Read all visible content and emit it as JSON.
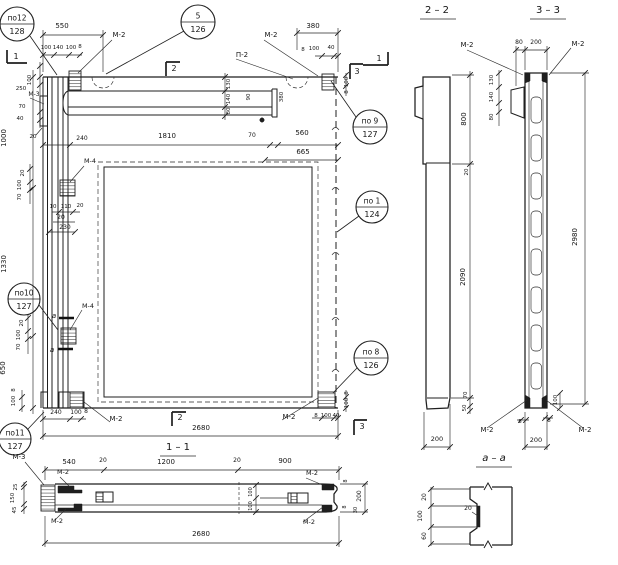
{
  "colors": {
    "ink": "#1f1f1f",
    "paper": "#ffffff"
  },
  "views": {
    "main_elevation": {
      "labels": [
        {
          "t": "550",
          "x": 62,
          "y": 28
        },
        {
          "t": "100",
          "x": 46,
          "y": 49,
          "s": 5.5
        },
        {
          "t": "140",
          "x": 58,
          "y": 49,
          "s": 5.5
        },
        {
          "t": "100",
          "x": 71,
          "y": 49,
          "s": 5.5
        },
        {
          "t": "8",
          "x": 80,
          "y": 48,
          "s": 5.5
        },
        {
          "t": "М-2",
          "x": 119,
          "y": 37
        },
        {
          "t": "П-2",
          "x": 242,
          "y": 57
        },
        {
          "t": "М-2",
          "x": 271,
          "y": 37
        },
        {
          "t": "380",
          "x": 313,
          "y": 28
        },
        {
          "t": "8",
          "x": 303,
          "y": 51,
          "s": 5.5
        },
        {
          "t": "100",
          "x": 314,
          "y": 50,
          "s": 5.5
        },
        {
          "t": "40",
          "x": 331,
          "y": 49,
          "s": 5.5
        },
        {
          "t": "1",
          "x": 16,
          "y": 59,
          "s": 8,
          "n": "section-mark-1"
        },
        {
          "t": "2",
          "x": 174,
          "y": 71,
          "s": 8,
          "n": "section-mark-2"
        },
        {
          "t": "1",
          "x": 379,
          "y": 61,
          "s": 8,
          "n": "section-mark-1"
        },
        {
          "t": "3",
          "x": 357,
          "y": 74,
          "s": 8,
          "n": "section-mark-3"
        },
        {
          "t": "100",
          "x": 31,
          "y": 80,
          "r": 1,
          "s": 5.5
        },
        {
          "t": "250",
          "x": 21,
          "y": 90,
          "s": 5.5
        },
        {
          "t": "М-3",
          "x": 34,
          "y": 96,
          "s": 6
        },
        {
          "t": "70",
          "x": 22,
          "y": 108,
          "s": 5.5
        },
        {
          "t": "40",
          "x": 20,
          "y": 120,
          "s": 5.5
        },
        {
          "t": "1000",
          "x": 6,
          "y": 138,
          "r": 1
        },
        {
          "t": "20",
          "x": 33,
          "y": 138,
          "s": 5.5
        },
        {
          "t": "240",
          "x": 82,
          "y": 140,
          "s": 6
        },
        {
          "t": "1810",
          "x": 167,
          "y": 138
        },
        {
          "t": "130",
          "x": 230,
          "y": 84,
          "r": 1,
          "s": 5.5
        },
        {
          "t": "140",
          "x": 230,
          "y": 99,
          "r": 1,
          "s": 5.5
        },
        {
          "t": "80",
          "x": 230,
          "y": 111,
          "r": 1,
          "s": 5.5
        },
        {
          "t": "90",
          "x": 250,
          "y": 97,
          "r": 1,
          "s": 5.5
        },
        {
          "t": "380",
          "x": 283,
          "y": 97,
          "r": 1,
          "s": 5.5
        },
        {
          "t": "70",
          "x": 252,
          "y": 137,
          "s": 6
        },
        {
          "t": "560",
          "x": 302,
          "y": 135
        },
        {
          "t": "665",
          "x": 303,
          "y": 154
        },
        {
          "t": "М-4",
          "x": 90,
          "y": 163,
          "s": 6.5
        },
        {
          "t": "20",
          "x": 24,
          "y": 173,
          "r": 1,
          "s": 5.5
        },
        {
          "t": "100",
          "x": 21,
          "y": 185,
          "r": 1,
          "s": 5.5
        },
        {
          "t": "70",
          "x": 21,
          "y": 197,
          "r": 1,
          "s": 5.5
        },
        {
          "t": "10",
          "x": 53,
          "y": 208,
          "s": 5.5
        },
        {
          "t": "110",
          "x": 66,
          "y": 208,
          "s": 5.5
        },
        {
          "t": "20",
          "x": 80,
          "y": 207,
          "s": 5.5
        },
        {
          "t": "20",
          "x": 61,
          "y": 219,
          "s": 6
        },
        {
          "t": "230",
          "x": 65,
          "y": 229,
          "s": 6
        },
        {
          "t": "1330",
          "x": 6,
          "y": 264,
          "r": 1
        },
        {
          "t": "М-4",
          "x": 88,
          "y": 308,
          "s": 6.5
        },
        {
          "t": "а",
          "x": 54,
          "y": 318,
          "s": 7,
          "i": 1
        },
        {
          "t": "а",
          "x": 52,
          "y": 352,
          "s": 7,
          "i": 1
        },
        {
          "t": "20",
          "x": 23,
          "y": 323,
          "r": 1,
          "s": 5.5
        },
        {
          "t": "100",
          "x": 20,
          "y": 335,
          "r": 1,
          "s": 5.5
        },
        {
          "t": "70",
          "x": 20,
          "y": 347,
          "r": 1,
          "s": 5.5
        },
        {
          "t": "650",
          "x": 5,
          "y": 368,
          "r": 1
        },
        {
          "t": "8",
          "x": 15,
          "y": 390,
          "r": 1,
          "s": 5.5
        },
        {
          "t": "100",
          "x": 15,
          "y": 401,
          "r": 1,
          "s": 5.5
        },
        {
          "t": "240",
          "x": 56,
          "y": 414,
          "s": 6
        },
        {
          "t": "100",
          "x": 76,
          "y": 414,
          "s": 6
        },
        {
          "t": "8",
          "x": 86,
          "y": 413,
          "s": 6
        },
        {
          "t": "М-2",
          "x": 116,
          "y": 421
        },
        {
          "t": "2",
          "x": 180,
          "y": 420,
          "s": 8,
          "n": "section-mark-2"
        },
        {
          "t": "2680",
          "x": 201,
          "y": 430
        },
        {
          "t": "М-2",
          "x": 289,
          "y": 419
        },
        {
          "t": "8",
          "x": 316,
          "y": 417,
          "s": 5.5
        },
        {
          "t": "100",
          "x": 326,
          "y": 417,
          "s": 5.5
        },
        {
          "t": "40",
          "x": 336,
          "y": 417,
          "s": 5.5
        },
        {
          "t": "3",
          "x": 362,
          "y": 429,
          "s": 8,
          "n": "section-mark-3"
        },
        {
          "t": "100",
          "x": 348,
          "y": 82,
          "r": 1,
          "s": 5.5
        },
        {
          "t": "8",
          "x": 348,
          "y": 92,
          "r": 1,
          "s": 5.5
        },
        {
          "t": "8",
          "x": 348,
          "y": 393,
          "r": 1,
          "s": 5.5
        },
        {
          "t": "100",
          "x": 348,
          "y": 403,
          "r": 1,
          "s": 5.5
        }
      ]
    },
    "section_2_2": {
      "labels": [
        {
          "t": "2 – 2",
          "x": 437,
          "y": 13,
          "s": 10,
          "n": "section-title"
        },
        {
          "t": "800",
          "x": 466,
          "y": 119,
          "r": 1
        },
        {
          "t": "20",
          "x": 468,
          "y": 172,
          "r": 1,
          "s": 5.5
        },
        {
          "t": "2090",
          "x": 465,
          "y": 277,
          "r": 1
        },
        {
          "t": "70",
          "x": 467,
          "y": 395,
          "r": 1,
          "s": 5.5
        },
        {
          "t": "50",
          "x": 466,
          "y": 408,
          "r": 1,
          "s": 5.5
        },
        {
          "t": "200",
          "x": 437,
          "y": 441,
          "s": 6.5
        }
      ]
    },
    "section_3_3": {
      "labels": [
        {
          "t": "3 – 3",
          "x": 548,
          "y": 13,
          "s": 10,
          "n": "section-title"
        },
        {
          "t": "М-2",
          "x": 467,
          "y": 47
        },
        {
          "t": "М-2",
          "x": 578,
          "y": 46
        },
        {
          "t": "80",
          "x": 519,
          "y": 44,
          "s": 6
        },
        {
          "t": "200",
          "x": 536,
          "y": 44,
          "s": 6
        },
        {
          "t": "130",
          "x": 493,
          "y": 80,
          "r": 1,
          "s": 5.5
        },
        {
          "t": "140",
          "x": 493,
          "y": 97,
          "r": 1,
          "s": 5.5
        },
        {
          "t": "80",
          "x": 493,
          "y": 117,
          "r": 1,
          "s": 5.5
        },
        {
          "t": "2980",
          "x": 577,
          "y": 237,
          "r": 1
        },
        {
          "t": "100",
          "x": 557,
          "y": 400,
          "r": 1,
          "s": 5.5
        },
        {
          "t": "8",
          "x": 520,
          "y": 423,
          "s": 5.5
        },
        {
          "t": "8",
          "x": 549,
          "y": 422,
          "s": 5.5
        },
        {
          "t": "М-2",
          "x": 487,
          "y": 432
        },
        {
          "t": "М-2",
          "x": 585,
          "y": 432
        },
        {
          "t": "200",
          "x": 536,
          "y": 442,
          "s": 6.5
        }
      ]
    },
    "section_1_1": {
      "labels": [
        {
          "t": "1 – 1",
          "x": 178,
          "y": 450,
          "s": 10,
          "n": "section-title"
        },
        {
          "t": "М-3",
          "x": 19,
          "y": 459
        },
        {
          "t": "540",
          "x": 69,
          "y": 464
        },
        {
          "t": "20",
          "x": 103,
          "y": 462,
          "s": 6
        },
        {
          "t": "1200",
          "x": 166,
          "y": 464
        },
        {
          "t": "20",
          "x": 237,
          "y": 462,
          "s": 6
        },
        {
          "t": "900",
          "x": 285,
          "y": 463
        },
        {
          "t": "М-2",
          "x": 63,
          "y": 474,
          "s": 6.5
        },
        {
          "t": "М-2",
          "x": 312,
          "y": 475,
          "s": 6.5
        },
        {
          "t": "25",
          "x": 17,
          "y": 487,
          "r": 1,
          "s": 5.5
        },
        {
          "t": "150",
          "x": 14,
          "y": 498,
          "r": 1,
          "s": 5.5
        },
        {
          "t": "45",
          "x": 16,
          "y": 510,
          "r": 1,
          "s": 5.5
        },
        {
          "t": "100",
          "x": 252,
          "y": 492,
          "r": 1,
          "s": 5
        },
        {
          "t": "100",
          "x": 252,
          "y": 506,
          "r": 1,
          "s": 5
        },
        {
          "t": "8",
          "x": 347,
          "y": 481,
          "r": 1,
          "s": 5
        },
        {
          "t": "200",
          "x": 361,
          "y": 496,
          "r": 1,
          "s": 6
        },
        {
          "t": "8",
          "x": 346,
          "y": 507,
          "r": 1,
          "s": 5
        },
        {
          "t": "30",
          "x": 357,
          "y": 510,
          "r": 1,
          "s": 5
        },
        {
          "t": "М-2",
          "x": 57,
          "y": 523,
          "s": 6.5
        },
        {
          "t": "М-2",
          "x": 309,
          "y": 524,
          "s": 6.5
        },
        {
          "t": "2680",
          "x": 201,
          "y": 536
        }
      ]
    },
    "detail_a_a": {
      "labels": [
        {
          "t": "а – а",
          "x": 494,
          "y": 461,
          "s": 10,
          "i": 1,
          "n": "section-title"
        },
        {
          "t": "20",
          "x": 426,
          "y": 497,
          "r": 1,
          "s": 6
        },
        {
          "t": "100",
          "x": 422,
          "y": 516,
          "r": 1,
          "s": 6
        },
        {
          "t": "60",
          "x": 426,
          "y": 536,
          "r": 1,
          "s": 6
        },
        {
          "t": "20",
          "x": 468,
          "y": 510,
          "s": 6
        }
      ]
    }
  },
  "callouts": [
    {
      "top": "по12",
      "bottom": "128",
      "cx": 17,
      "cy": 24,
      "r": 17,
      "lx1": 30,
      "ly1": 36,
      "lx2": 57,
      "ly2": 75
    },
    {
      "top": "5",
      "bottom": "126",
      "cx": 198,
      "cy": 22,
      "r": 17,
      "lx1": 184,
      "ly1": 31,
      "lx2": 106,
      "ly2": 74
    },
    {
      "top": "по 9",
      "bottom": "127",
      "cx": 370,
      "cy": 127,
      "r": 17,
      "lx1": 356,
      "ly1": 117,
      "lx2": 331,
      "ly2": 81
    },
    {
      "top": "по 1",
      "bottom": "124",
      "cx": 372,
      "cy": 207,
      "r": 16,
      "lx1": 359,
      "ly1": 216,
      "lx2": 337,
      "ly2": 232
    },
    {
      "top": "по 8",
      "bottom": "126",
      "cx": 371,
      "cy": 358,
      "r": 17,
      "lx1": 357,
      "ly1": 368,
      "lx2": 333,
      "ly2": 393
    },
    {
      "top": "по10",
      "bottom": "127",
      "cx": 24,
      "cy": 299,
      "r": 16,
      "lx1": 39,
      "ly1": 305,
      "lx2": 58,
      "ly2": 330
    },
    {
      "top": "по11",
      "bottom": "127",
      "cx": 15,
      "cy": 439,
      "r": 16,
      "lx1": 28,
      "ly1": 429,
      "lx2": 44,
      "ly2": 412
    }
  ]
}
